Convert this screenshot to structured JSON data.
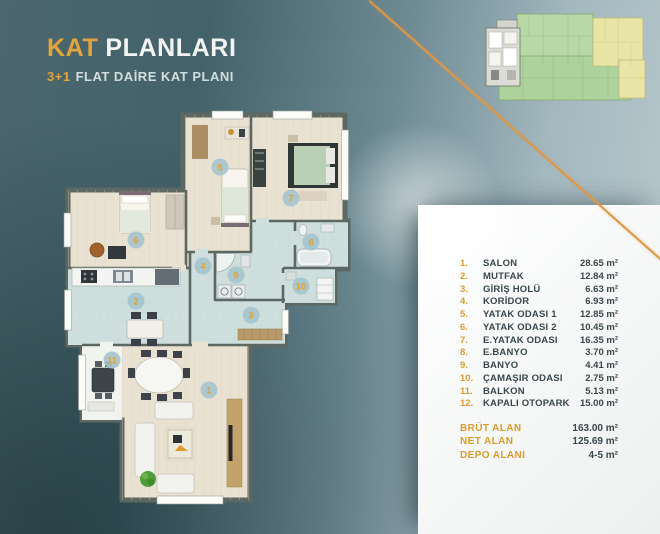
{
  "header": {
    "title_accent": "KAT",
    "title_rest": "PLANLARI",
    "subtitle_accent": "3+1",
    "subtitle_rest": "FLAT DAİRE KAT PLANI"
  },
  "colors": {
    "accent_orange": "#e3a43c",
    "teal_dark": "#2e5156",
    "teal_light": "#a3b8bf",
    "panel_white": "#f5f7f6",
    "text_dark": "#39474c",
    "wall": "#5d6862",
    "floor_wood": "#e9e1d2",
    "floor_tile": "#cfdfde",
    "marker_fill": "#a6c4cc"
  },
  "key_plan": {
    "highlight_unit": "gray-left-unit",
    "zones": [
      "highlighted-flat",
      "green-block",
      "yellow-block"
    ]
  },
  "room_list": {
    "rows": [
      {
        "no": "1.",
        "name": "SALON",
        "area": "28.65 m²"
      },
      {
        "no": "2.",
        "name": "MUTFAK",
        "area": "12.84 m²"
      },
      {
        "no": "3.",
        "name": "GİRİŞ HOLÜ",
        "area": "6.63 m²"
      },
      {
        "no": "4.",
        "name": "KORİDOR",
        "area": "6.93 m²"
      },
      {
        "no": "5.",
        "name": "YATAK ODASI 1",
        "area": "12.85 m²"
      },
      {
        "no": "6.",
        "name": "YATAK ODASI 2",
        "area": "10.45 m²"
      },
      {
        "no": "7.",
        "name": "E.YATAK ODASI",
        "area": "16.35 m²"
      },
      {
        "no": "8.",
        "name": "E.BANYO",
        "area": "3.70 m²"
      },
      {
        "no": "9.",
        "name": "BANYO",
        "area": "4.41 m²"
      },
      {
        "no": "10.",
        "name": "ÇAMAŞIR ODASI",
        "area": "2.75 m²"
      },
      {
        "no": "11.",
        "name": "BALKON",
        "area": "5.13 m²"
      },
      {
        "no": "12.",
        "name": "KAPALI OTOPARK",
        "area": "15.00 m²"
      }
    ]
  },
  "totals": [
    {
      "label": "BRÜT ALAN",
      "value": "163.00 m²"
    },
    {
      "label": "NET ALAN",
      "value": "125.69 m²"
    },
    {
      "label": "DEPO ALANI",
      "value": "4-5 m²"
    }
  ],
  "plan": {
    "markers": [
      {
        "num": "1",
        "room": "salon"
      },
      {
        "num": "2",
        "room": "mutfak"
      },
      {
        "num": "3",
        "room": "giris-holu"
      },
      {
        "num": "4",
        "room": "koridor"
      },
      {
        "num": "5",
        "room": "yatak-odasi-1"
      },
      {
        "num": "6",
        "room": "yatak-odasi-2"
      },
      {
        "num": "7",
        "room": "e-yatak-odasi"
      },
      {
        "num": "8",
        "room": "e-banyo"
      },
      {
        "num": "9",
        "room": "banyo"
      },
      {
        "num": "10",
        "room": "camasir-odasi"
      },
      {
        "num": "11",
        "room": "balkon"
      }
    ]
  }
}
